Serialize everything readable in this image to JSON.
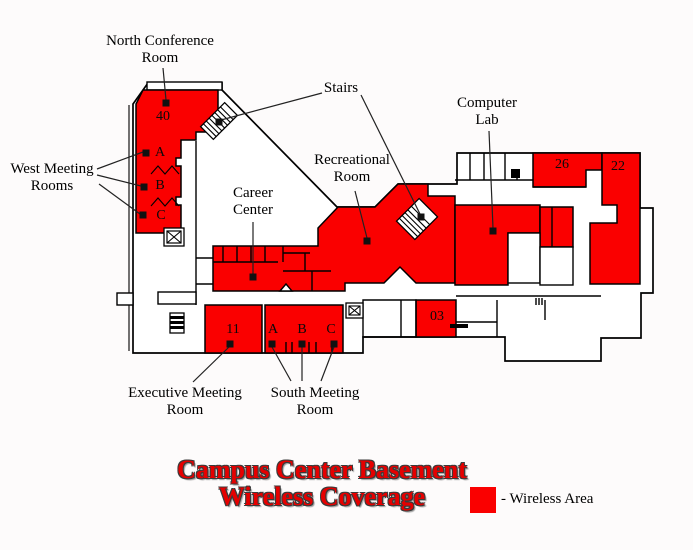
{
  "title": {
    "text": "Campus Center Basement\nWireless Coverage"
  },
  "legend": {
    "label": "- Wireless Area"
  },
  "colors": {
    "wireless_area": "#fa0000",
    "title_red": "#e60000",
    "walls": "#000000"
  },
  "area_labels": {
    "north_conference": "North Conference\nRoom",
    "west_meeting": "West Meeting\nRooms",
    "stairs": "Stairs",
    "computer_lab": "Computer\nLab",
    "recreational": "Recreational\nRoom",
    "career": "Career\nCenter",
    "executive": "Executive Meeting\nRoom",
    "south_meeting": "South Meeting\nRoom"
  },
  "room_labels": {
    "north_conference_40": "40",
    "west_a": "A",
    "west_b": "B",
    "west_c": "C",
    "room_26": "26",
    "room_22": "22",
    "executive_11": "11",
    "south_a": "A",
    "south_b": "B",
    "south_c": "C",
    "room_03": "03"
  }
}
